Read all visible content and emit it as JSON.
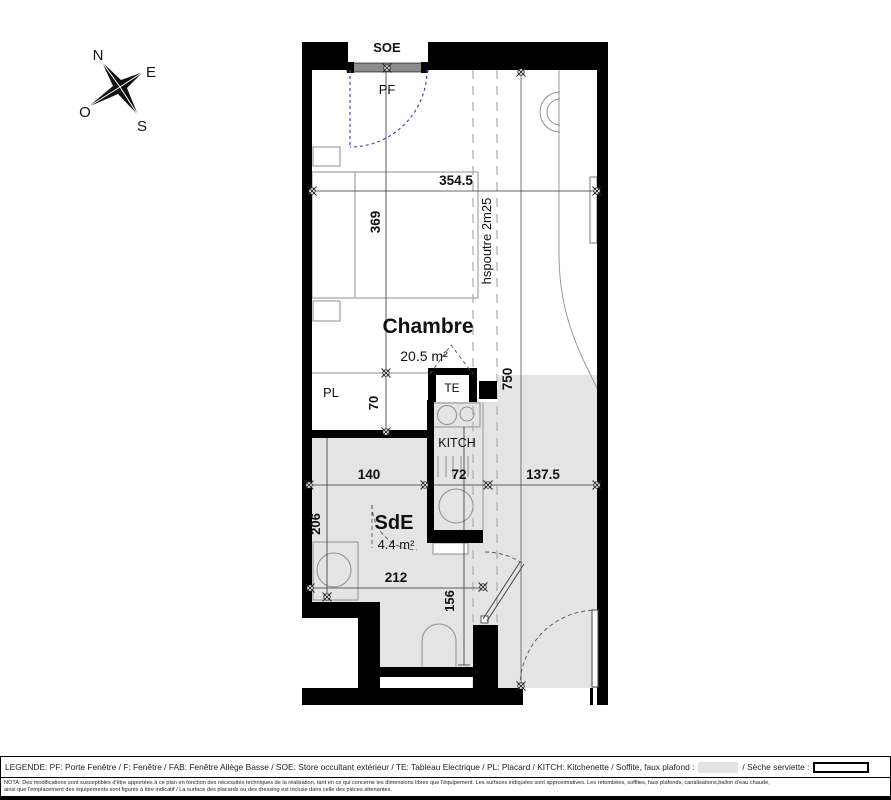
{
  "compass": {
    "north": "N",
    "east": "E",
    "west": "O",
    "south": "S"
  },
  "labels": {
    "soe": "SOE",
    "pf": "PF",
    "pl": "PL",
    "te": "TE",
    "kitch": "KITCH",
    "beam": "hspoutre 2m25"
  },
  "rooms": {
    "chambre": {
      "name": "Chambre",
      "area": "20.5 m²"
    },
    "sde": {
      "name": "SdE",
      "area": "4.4 m²"
    }
  },
  "dims": {
    "top_width": "354.5",
    "chambre_depth": "369",
    "pl_depth": "70",
    "total_depth": "750",
    "left_width": "140",
    "kitchen_width": "72",
    "right_width": "137.5",
    "sde_depth": "206",
    "sde_width": "212",
    "hall_depth": "156"
  },
  "legend": {
    "part1": "LEGENDE: PF: Porte Fenêtre / F: Fenêtre / FAB: Fenêtre Allège Basse / SOE: Store occultant extérieur / TE: Tableau Electrique / PL: Placard / KITCH: Kitchenette / Soffite, faux plafond :",
    "part2": "/ Sèche serviette :"
  },
  "nota": {
    "line1": "NOTA: Des modifications sont susceptibles d'être apportées à ce plan en fonction des nécessités techniques de la réalisation, tant en ce qui concerne les dimensions libres que l'équipement. Les surfaces indiquées sont approximatives. Les retombées, soffites, faux plafonds, canalisations,ballon d'eau chaude,",
    "line2": "ainsi que l'emplacement des équipements sont figurés à titre indicatif / La surface des placards ou des dressing est incluse dans celle des pièces attenantes."
  },
  "colors": {
    "wall": "#000000",
    "soffite": "#e4e4e4",
    "door_swing": "#4747c0"
  }
}
